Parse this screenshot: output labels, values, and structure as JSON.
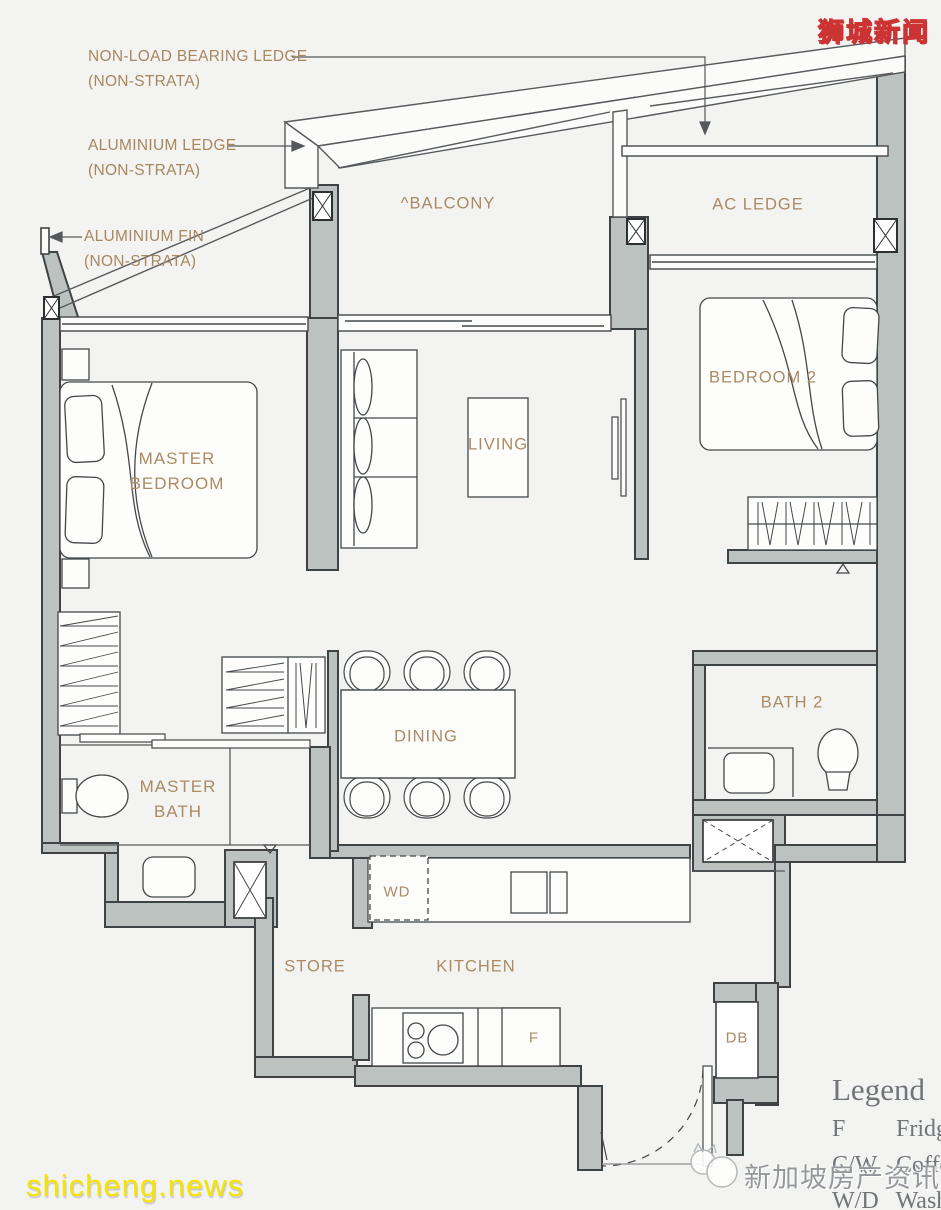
{
  "watermarks": {
    "top_right": "狮城新闻",
    "bottom_left": "shicheng.news",
    "bottom_right": "新加坡房产资讯"
  },
  "annotations": {
    "non_load_bearing_ledge": {
      "line1": "NON-LOAD BEARING LEDGE",
      "line2": "(NON-STRATA)"
    },
    "aluminium_ledge": {
      "line1": "ALUMINIUM LEDGE",
      "line2": "(NON-STRATA)"
    },
    "aluminium_fin": {
      "line1": "ALUMINIUM FIN",
      "line2": "(NON-STRATA)"
    }
  },
  "rooms": {
    "balcony": "^BALCONY",
    "ac_ledge": "AC LEDGE",
    "master_bedroom": "MASTER BEDROOM",
    "living": "LIVING",
    "bedroom2": "BEDROOM 2",
    "dining": "DINING",
    "master_bath": "MASTER BATH",
    "bath2": "BATH 2",
    "store": "STORE",
    "kitchen": "KITCHEN",
    "wd": "WD",
    "fridge": "F",
    "db": "DB"
  },
  "legend": {
    "title": "Legend",
    "rows": [
      {
        "key": "F",
        "value": "Fridge"
      },
      {
        "key": "C/W",
        "value": "Coffee"
      },
      {
        "key": "W/D",
        "value": "Wash"
      }
    ]
  },
  "colors": {
    "background": "#f3f3f1",
    "wall_fill": "#bcc2bf",
    "wall_stroke": "#3f4345",
    "label_text": "#ab8a64",
    "legend_text": "#70757a",
    "watermark_yellow": "#ffe400",
    "watermark_red_outline": "#cc3333"
  }
}
